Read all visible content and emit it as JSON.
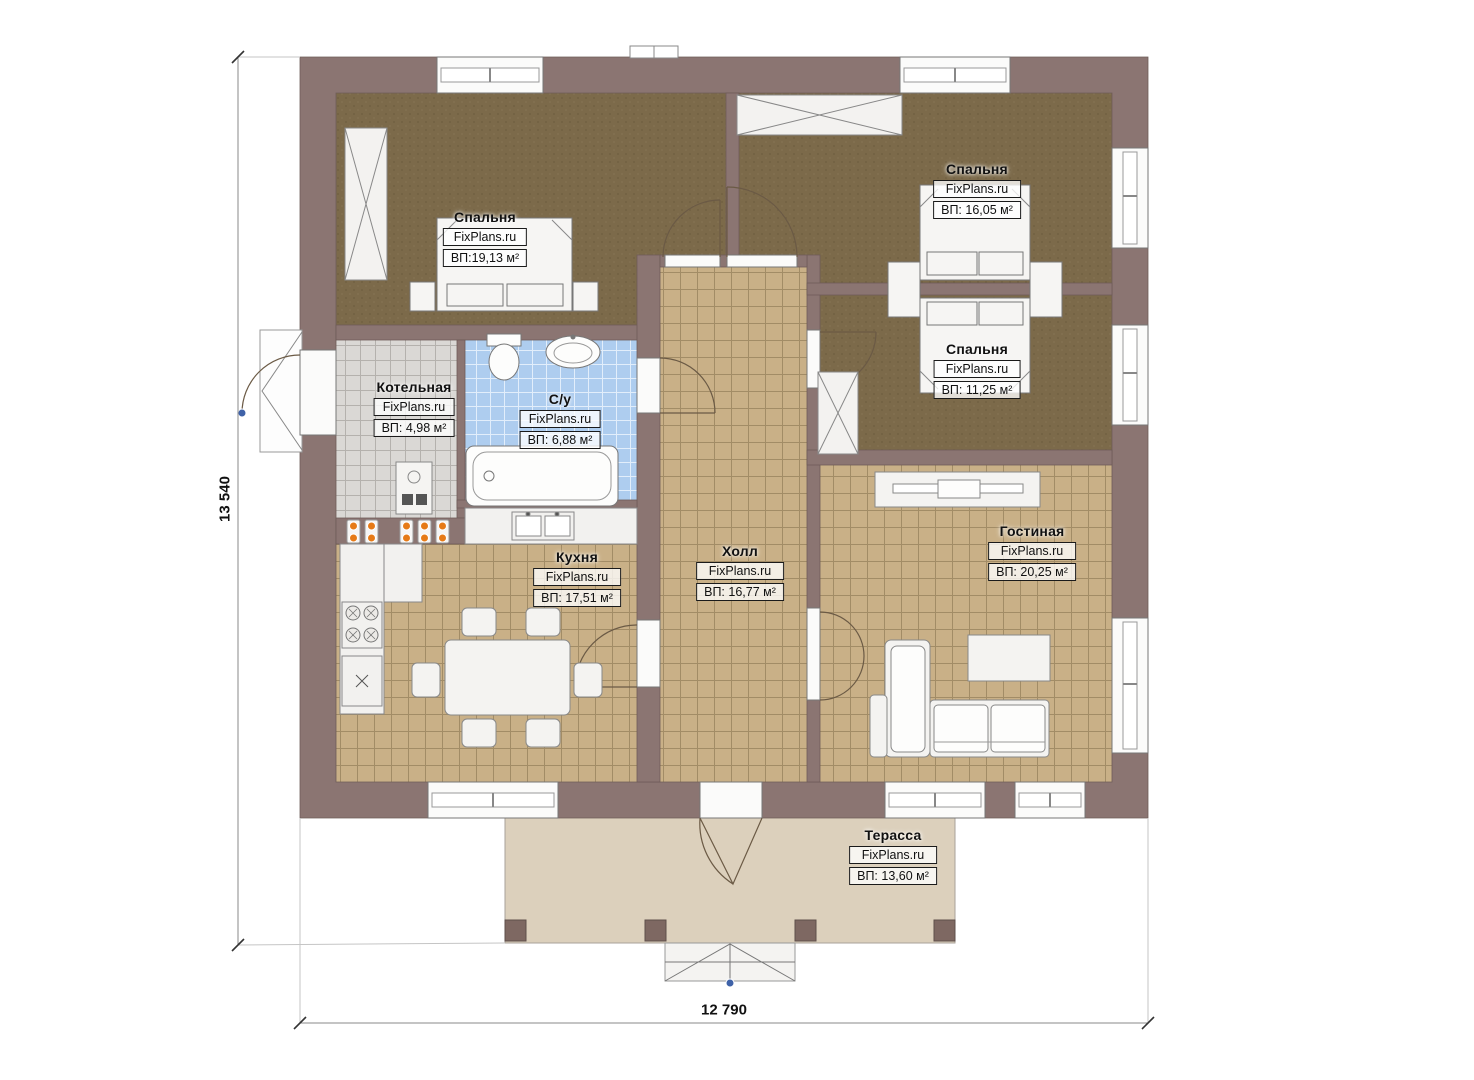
{
  "dimensions": {
    "height": "13 540",
    "width": "12 790"
  },
  "rooms": [
    {
      "id": "bedroom-1",
      "name": "Спальня",
      "brand": "FixPlans.ru",
      "area": "ВП:19,13 м²"
    },
    {
      "id": "bedroom-2",
      "name": "Спальня",
      "brand": "FixPlans.ru",
      "area": "ВП: 16,05 м²"
    },
    {
      "id": "bedroom-3",
      "name": "Спальня",
      "brand": "FixPlans.ru",
      "area": "ВП: 11,25 м²"
    },
    {
      "id": "boiler",
      "name": "Котельная",
      "brand": "FixPlans.ru",
      "area": "ВП: 4,98 м²"
    },
    {
      "id": "bathroom",
      "name": "С/у",
      "brand": "FixPlans.ru",
      "area": "ВП: 6,88 м²"
    },
    {
      "id": "kitchen",
      "name": "Кухня",
      "brand": "FixPlans.ru",
      "area": "ВП: 17,51 м²"
    },
    {
      "id": "hall",
      "name": "Холл",
      "brand": "FixPlans.ru",
      "area": "ВП: 16,77 м²"
    },
    {
      "id": "living",
      "name": "Гостиная",
      "brand": "FixPlans.ru",
      "area": "ВП: 20,25 м²"
    },
    {
      "id": "terrace",
      "name": "Терасса",
      "brand": "FixPlans.ru",
      "area": "ВП: 13,60 м²"
    }
  ],
  "colors": {
    "wall": "#8b7572",
    "bedroom_floor": "#7c6a4a",
    "tile_floor": "#c9b087",
    "boiler_tile": "#dad8d5",
    "bathroom_tile": "#aecdef",
    "terrace_floor": "#dcd0bc",
    "valve_orange": "#e67a17",
    "marker_blue": "#3f62a8"
  }
}
